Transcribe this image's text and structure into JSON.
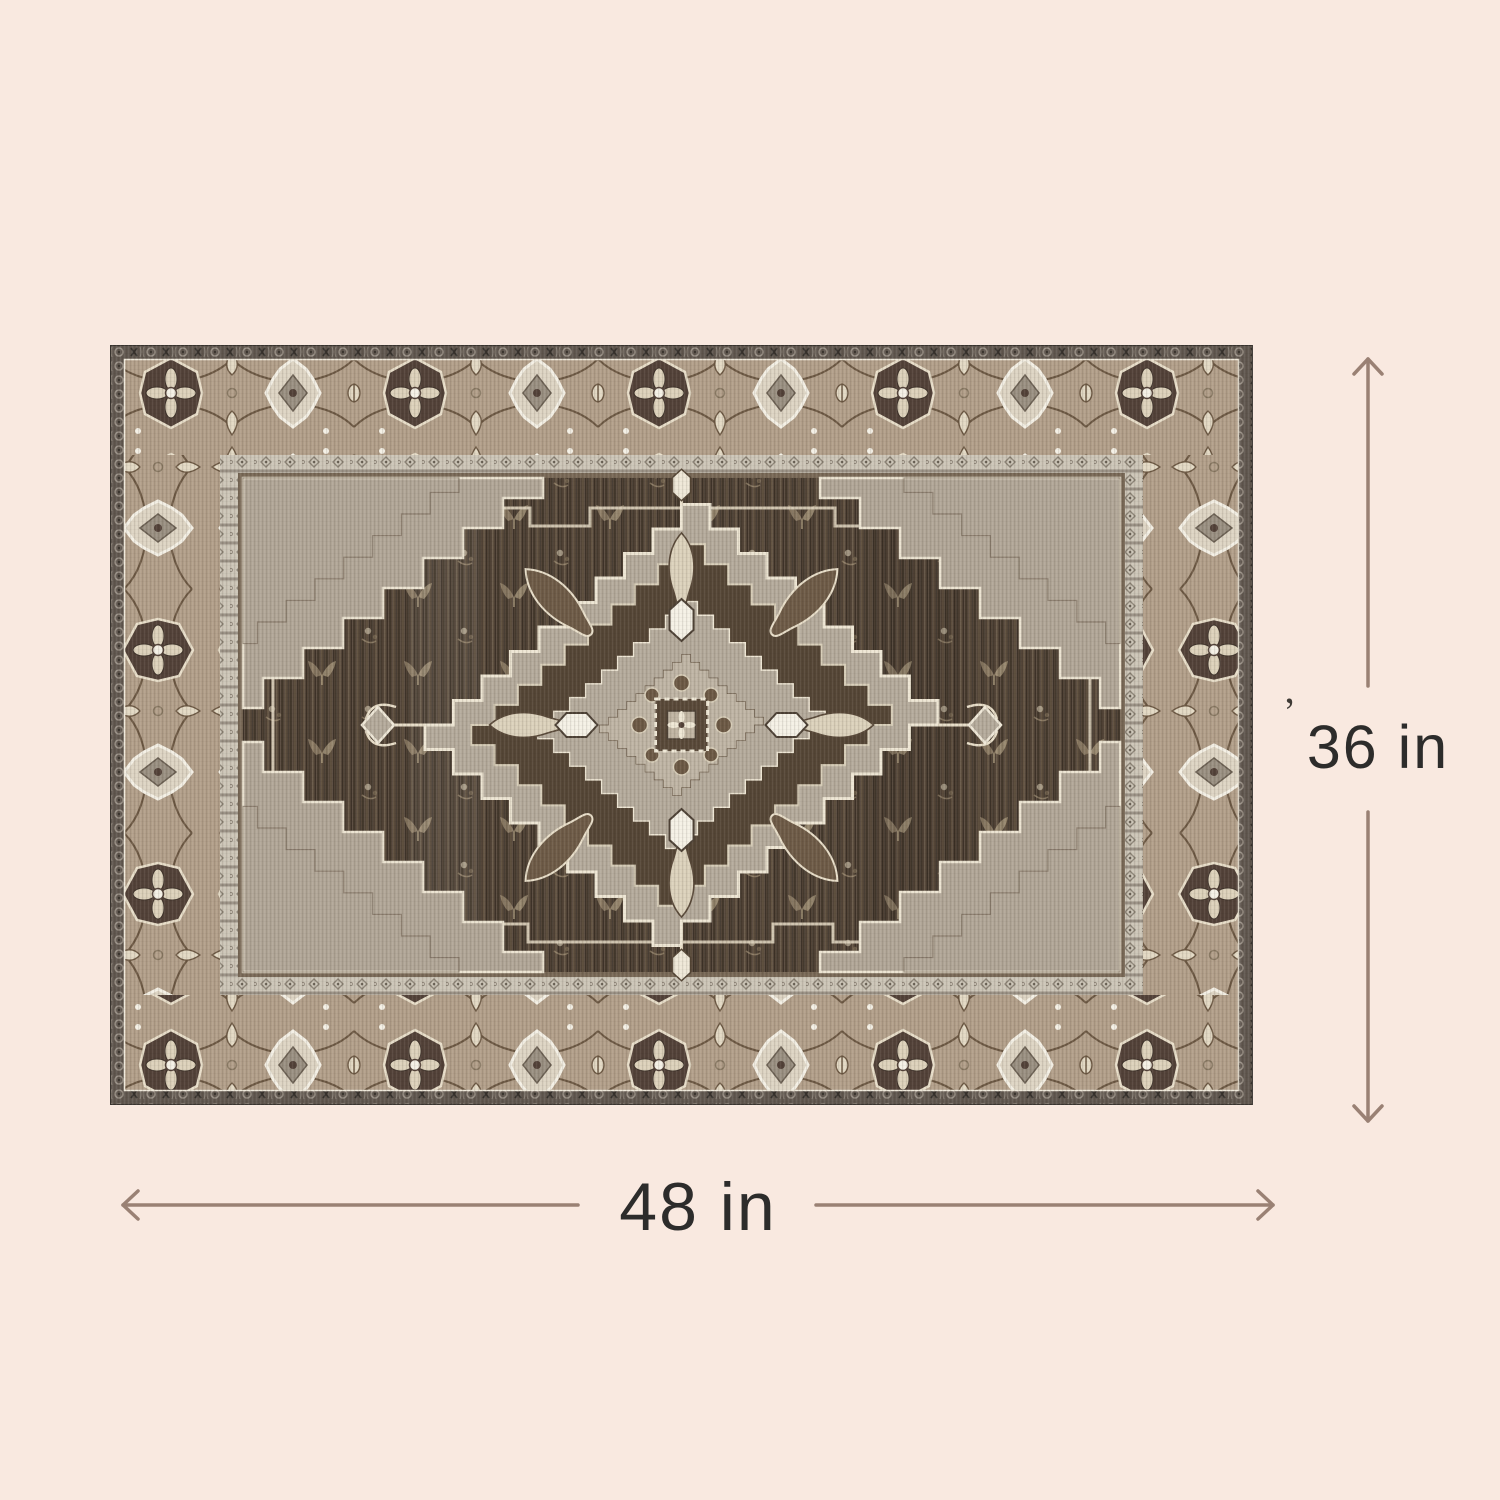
{
  "page": {
    "background_color": "#f9e9e0",
    "content": "product dimension diagram of an oriental medallion area rug"
  },
  "rug": {
    "style": "vintage heriz medallion rug",
    "colors": {
      "outer_band": "#625951",
      "main_border_ground": "#b3a08b",
      "guard_band": "#cdc6b8",
      "field": "#544639",
      "medallion_light": "#b5ab9c",
      "medallion_dark": "#564737",
      "motif_cream": "#e9dfca",
      "motif_white": "#f5f1e6",
      "motif_dark_brown": "#54433a"
    }
  },
  "dimensions": {
    "height": {
      "label": "36 in"
    },
    "width": {
      "label": "48 in"
    },
    "stray_mark": "’",
    "arrow_color": "#9a8174",
    "label_color": "#2d2c2b"
  }
}
